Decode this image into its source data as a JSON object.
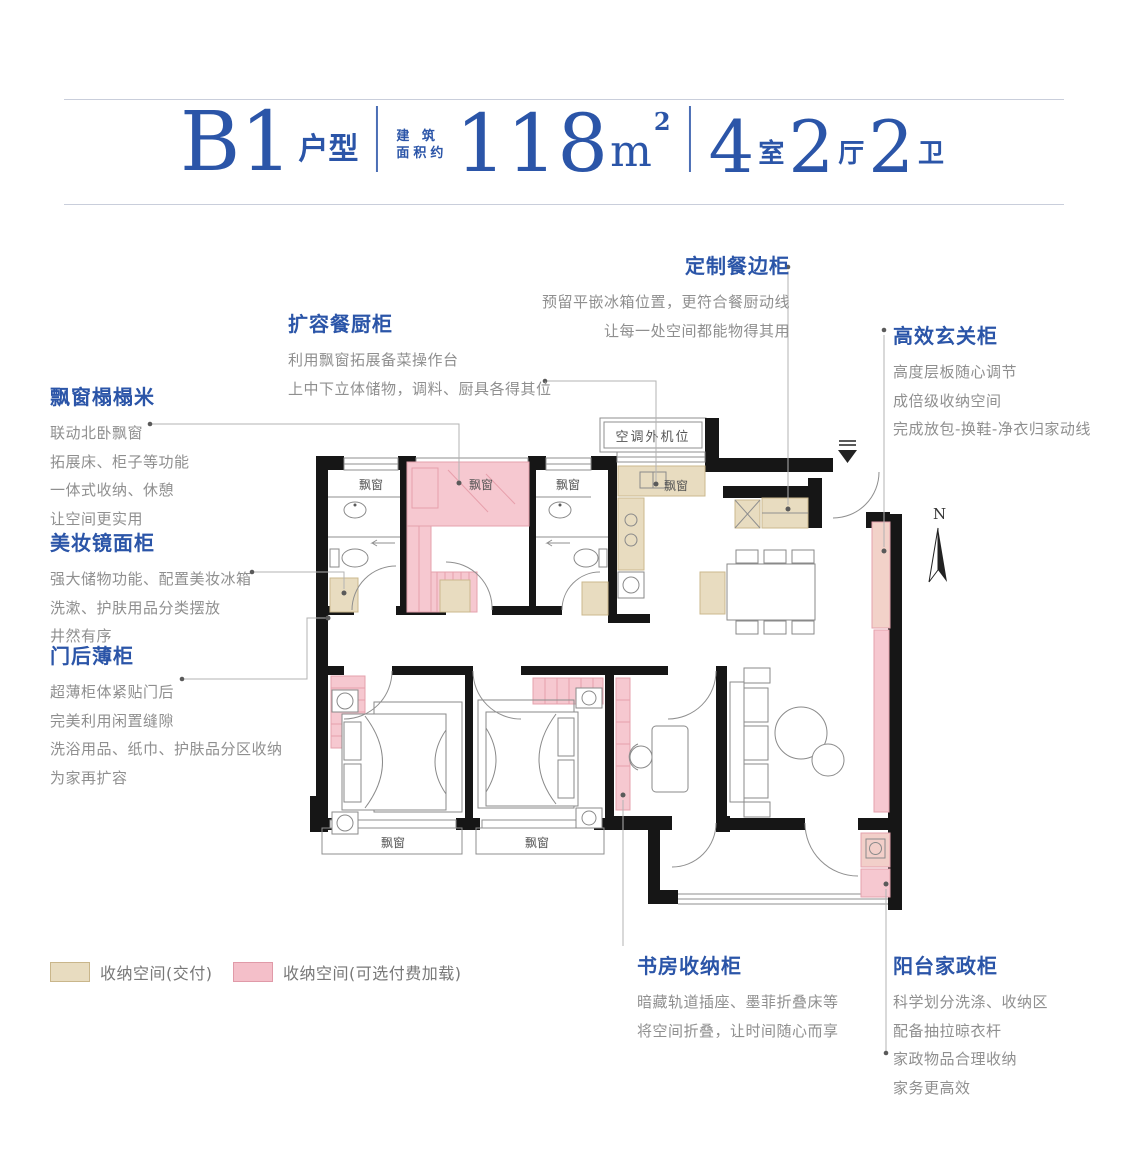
{
  "header": {
    "plan_name": "B1",
    "plan_suffix": "户型",
    "area_label_1": "建 筑",
    "area_label_2": "面积约",
    "area_num": "118",
    "area_unit": "m",
    "area_sup": "2",
    "rooms": [
      {
        "n": "4",
        "u": "室"
      },
      {
        "n": "2",
        "u": "厅"
      },
      {
        "n": "2",
        "u": "卫"
      }
    ]
  },
  "annotations": [
    {
      "title": "飘窗榻榻米",
      "lines": [
        "联动北卧飘窗",
        "拓展床、柜子等功能",
        "一体式收纳、休憩",
        "让空间更实用"
      ]
    },
    {
      "title": "美妆镜面柜",
      "lines": [
        "强大储物功能、配置美妆冰箱",
        "洗漱、护肤用品分类摆放",
        "井然有序"
      ]
    },
    {
      "title": "门后薄柜",
      "lines": [
        "超薄柜体紧贴门后",
        "完美利用闲置缝隙",
        "洗浴用品、纸巾、护肤品分区收纳",
        "为家再扩容"
      ]
    },
    {
      "title": "扩容餐厨柜",
      "lines": [
        "利用飘窗拓展备菜操作台",
        "上中下立体储物，调料、厨具各得其位"
      ]
    },
    {
      "title": "定制餐边柜",
      "lines": [
        "预留平嵌冰箱位置，更符合餐厨动线",
        "让每一处空间都能物得其用"
      ]
    },
    {
      "title": "高效玄关柜",
      "lines": [
        "高度层板随心调节",
        "成倍级收纳空间",
        "完成放包-换鞋-净衣归家动线"
      ]
    },
    {
      "title": "书房收纳柜",
      "lines": [
        "暗藏轨道插座、墨菲折叠床等",
        "将空间折叠，让时间随心而享"
      ]
    },
    {
      "title": "阳台家政柜",
      "lines": [
        "科学划分洗涤、收纳区",
        "配备抽拉晾衣杆",
        "家政物品合理收纳",
        "家务更高效"
      ]
    }
  ],
  "legend": [
    {
      "label": "收纳空间(交付)",
      "color": "#e8dcc0",
      "border": "#c9b68b"
    },
    {
      "label": "收纳空间(可选付费加载)",
      "color": "#f4bfc9",
      "border": "#e09aa8"
    }
  ],
  "plan": {
    "bay_window_label": "飘窗",
    "ac_label": "空调外机位",
    "north": "N"
  },
  "colors": {
    "title_blue": "#2b55a8",
    "body_gray": "#8f8f8f",
    "storage_delivered": "#e8dcc0",
    "storage_optional": "#f6c8d0",
    "wall": "#161616"
  }
}
